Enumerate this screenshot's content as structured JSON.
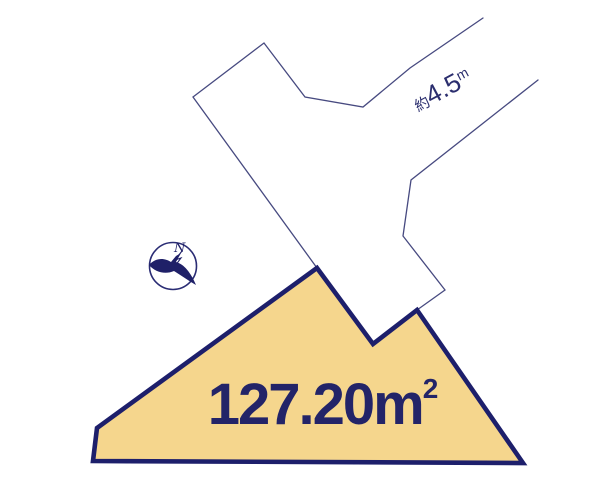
{
  "colors": {
    "navy": "#1d1f6b",
    "thin_line": "#474a80",
    "plot_fill": "#f5d68d",
    "background": "#ffffff"
  },
  "plot": {
    "area_value": "127.20",
    "area_unit": "m",
    "area_exponent": "2"
  },
  "road": {
    "width_prefix": "約",
    "width_value": "4.5",
    "width_unit": "m"
  },
  "compass": {
    "north_label": "N"
  }
}
